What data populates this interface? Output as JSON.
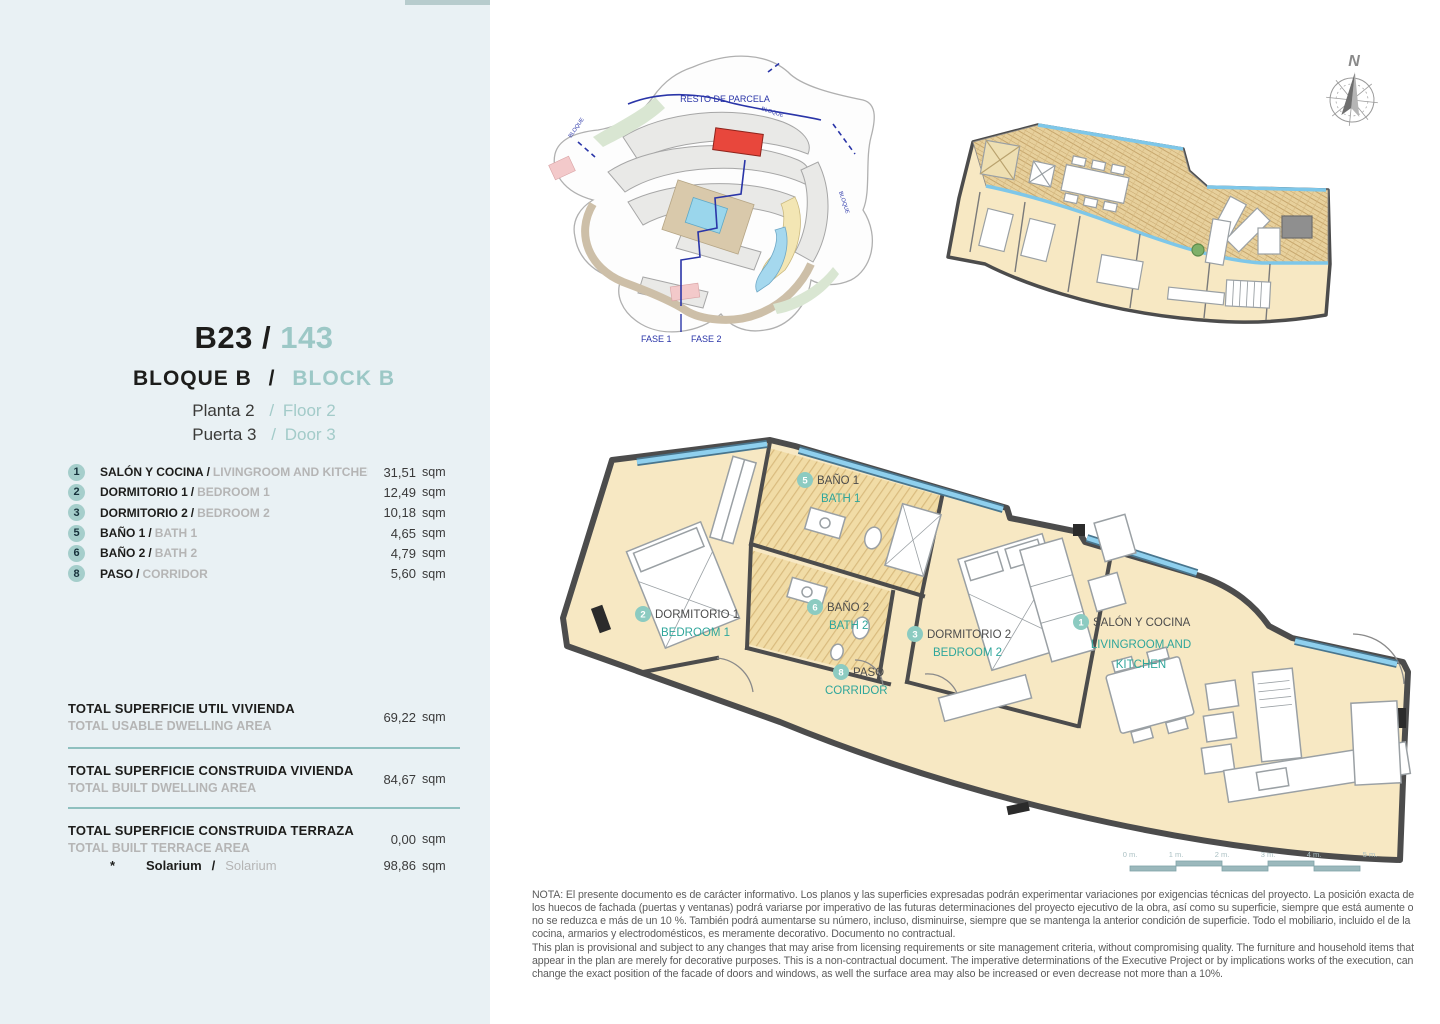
{
  "ui": {
    "slash": "/",
    "star": "*"
  },
  "sidebar": {
    "unit_code": "B23",
    "unit_number": "143",
    "block_es": "BLOQUE B",
    "block_en": "BLOCK B",
    "floor_es": "Planta 2",
    "floor_en": "Floor 2",
    "door_es": "Puerta 3",
    "door_en": "Door 3",
    "rooms": [
      {
        "num": "1",
        "name_es": "SALÓN Y COCINA",
        "name_en": "LIVINGROOM AND KITCHEN",
        "area": "31,51",
        "unit": "sqm"
      },
      {
        "num": "2",
        "name_es": "DORMITORIO 1",
        "name_en": "BEDROOM 1",
        "area": "12,49",
        "unit": "sqm"
      },
      {
        "num": "3",
        "name_es": "DORMITORIO 2",
        "name_en": "BEDROOM 2",
        "area": "10,18",
        "unit": "sqm"
      },
      {
        "num": "5",
        "name_es": "BAÑO 1",
        "name_en": "BATH 1",
        "area": "4,65",
        "unit": "sqm"
      },
      {
        "num": "6",
        "name_es": "BAÑO 2",
        "name_en": "BATH 2",
        "area": "4,79",
        "unit": "sqm"
      },
      {
        "num": "8",
        "name_es": "PASO",
        "name_en": "CORRIDOR",
        "area": "5,60",
        "unit": "sqm"
      }
    ],
    "totals": [
      {
        "title_es": "TOTAL SUPERFICIE UTIL VIVIENDA",
        "title_en": "TOTAL USABLE DWELLING AREA",
        "value": "69,22",
        "unit": "sqm"
      },
      {
        "title_es": "TOTAL SUPERFICIE CONSTRUIDA VIVIENDA",
        "title_en": "TOTAL BUILT DWELLING AREA",
        "value": "84,67",
        "unit": "sqm"
      },
      {
        "title_es": "TOTAL SUPERFICIE CONSTRUIDA TERRAZA",
        "title_en": "TOTAL BUILT TERRACE AREA",
        "value": "0,00",
        "unit": "sqm"
      }
    ],
    "solarium": {
      "name_es": "Solarium",
      "name_en": "Solarium",
      "value": "98,86",
      "unit": "sqm"
    }
  },
  "site_plan": {
    "resto_label": "RESTO DE PARCELA",
    "fase1_label": "FASE 1",
    "fase2_label": "FASE 2",
    "bloque_label": "BLOQUE"
  },
  "compass": {
    "north_label": "N"
  },
  "floor_plan": {
    "rooms": [
      {
        "num": "5",
        "name_es": "BAÑO 1",
        "name_en": "BATH 1"
      },
      {
        "num": "2",
        "name_es": "DORMITORIO 1",
        "name_en": "BEDROOM 1"
      },
      {
        "num": "6",
        "name_es": "BAÑO 2",
        "name_en": "BATH 2"
      },
      {
        "num": "3",
        "name_es": "DORMITORIO 2",
        "name_en": "BEDROOM 2"
      },
      {
        "num": "8",
        "name_es": "PASO",
        "name_en": "CORRIDOR"
      },
      {
        "num": "1",
        "name_es": "SALÓN Y COCINA",
        "name_en_line1": "LIVINGROOM AND",
        "name_en_line2": "KITCHEN"
      }
    ]
  },
  "scale_bar": {
    "labels": [
      "0 m.",
      "1 m.",
      "2 m.",
      "3 m.",
      "4 m.",
      "5 m."
    ]
  },
  "disclaimer": {
    "es": "NOTA: El presente documento es de carácter informativo. Los planos y las superficies expresadas podrán experimentar variaciones por exigencias técnicas del proyecto. La posición exacta de los huecos de fachada (puertas y ventanas) podrá variarse por imperativo de las futuras determinaciones del proyecto ejecutivo de la obra, así como su superficie, siempre que está aumente o no se reduzca e más de un 10 %. También podrá aumentarse su número, incluso, disminuirse, siempre que se mantenga la anterior condición de superficie. Todo el mobiliario, incluido el de la cocina, armarios y electrodomésticos, es meramente decorativo. Documento no contractual.",
    "en": "This plan is provisional and subject to any changes that may arise from licensing requirements or site management criteria, without compromising quality. The furniture and household items that appear in the plan are merely for decorative purposes. This is a non-contractual document. The imperative determinations of the Executive Project or by implications works of the execution, can change the exact position of the facade of doors and windows, as well the surface area may also be increased or even decrease not more than a 10%."
  },
  "colors": {
    "accent_teal": "#9cc8c6",
    "label_teal": "#2fa69b",
    "floor_cream": "#f7e8c3",
    "window_blue": "#7ec7e9",
    "highlight_red": "#e8473c",
    "boundary_blue": "#2a35a8",
    "sidebar_bg": "#e9f1f4"
  }
}
